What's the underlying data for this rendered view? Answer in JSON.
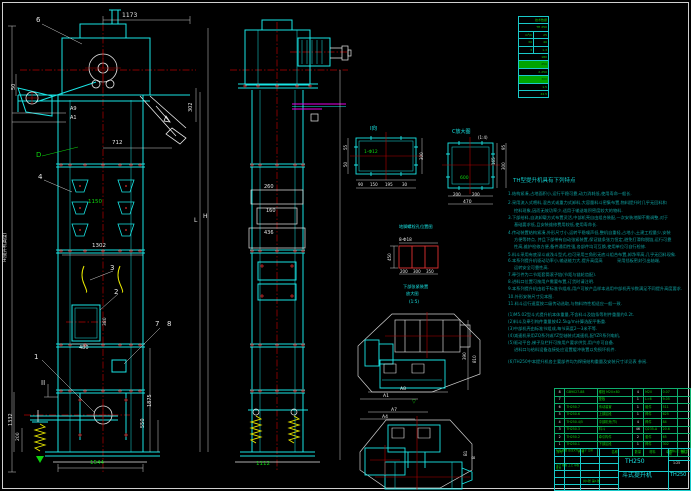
{
  "sheet_title": "TH250 斗式提升机 总图",
  "tech_table": {
    "name": "技术数据表",
    "rows": [
      {
        "cells": [
          "技术数据"
        ],
        "hl": false
      },
      {
        "cells": [
          "TH 250"
        ],
        "hl": false
      },
      {
        "cells": [
          "m³/h",
          "25"
        ],
        "hl": false
      },
      {
        "cells": [
          "30",
          "40"
        ],
        "hl": false
      },
      {
        "cells": [
          "3",
          "1.3"
        ],
        "hl": false
      },
      {
        "cells": [
          "180"
        ],
        "hl": false
      },
      {
        "cells": [
          "250"
        ],
        "hl": true
      },
      {
        "cells": [
          "2-250"
        ],
        "hl": false
      },
      {
        "cells": [
          "300"
        ],
        "hl": true
      },
      {
        "cells": [
          "1.5"
        ],
        "hl": false
      },
      {
        "cells": [
          "44.5"
        ],
        "hl": false
      }
    ]
  },
  "notes": {
    "title": {
      "t": "TH型提升机具有下列特点",
      "x": 513,
      "y": 179
    },
    "lines": [
      {
        "t": "1.结构紧凑,占地面积小,运行平稳可靠,动力消耗低,使用寿命—般长.",
        "x": 508,
        "y": 192
      },
      {
        "t": "2.采用流入式喂料,混合式或重力式卸料,大容量料斗密集布置,物料提升时几乎无回料和",
        "x": 508,
        "y": 201
      },
      {
        "t": "挖料现象,因而无效功率少,适用于输送堆积密度较大的物料.",
        "x": 514,
        "y": 209
      },
      {
        "t": "3.下部给料,自流卸载方式布置灵活,中部机壳自由组合装配,—次安装地脚不需调整,对于",
        "x": 508,
        "y": 216
      },
      {
        "t": "基础要求低,且安装维修费用较低,使用寿命长.",
        "x": 514,
        "y": 223
      },
      {
        "t": "4.传动装置结构紧凑,外形尺寸小,运转平稳噪声低,整机自重轻,占地小,土建工程量少,安装",
        "x": 508,
        "y": 231
      },
      {
        "t": "方便等特点, 并且下部带有自动张紧装置,保证链条张力恒定,避免打滑和脱链,运行可靠",
        "x": 514,
        "y": 238
      },
      {
        "t": "性高,维护检修方便,备件通用性强,各部件均可互换,使用单位可自行检修.",
        "x": 514,
        "y": 245
      },
      {
        "t": "5.料斗采用有底深斗或浅斗型式,也可采用三角形无底斗组合布置,卸净率高,几乎无回料现象.",
        "x": 508,
        "y": 253
      },
      {
        "t": "6.本系列提升机驱动功率小,输送能力大,提升高度高",
        "x": 508,
        "y": 259
      },
      {
        "t": "采用挡板密封引出轴端,",
        "x": 617,
        "y": 259
      },
      {
        "t": "运转安全可靠性高.",
        "x": 514,
        "y": 266
      },
      {
        "t": "7.牵引件为二节距套筒滚子链(节距与链轮齿配).",
        "x": 508,
        "y": 273
      },
      {
        "t": "8.进料口位置可按用户需要布置,订货时请注明.",
        "x": 508,
        "y": 280
      },
      {
        "t": "9.本系列提升机由若干标准节组成,用户可按产品样本选用中部机壳节数满足不同提升高度要求.",
        "x": 508,
        "y": 287
      },
      {
        "t": "10.外形安装尺寸见本图.",
        "x": 508,
        "y": 295
      },
      {
        "t": "11.料斗运行速度按二级传动选取,与物料特性相适应—般—致.",
        "x": 508,
        "y": 302
      },
      {
        "t": "(1)M5.02型斗式提升机本体重量,不含料斗及链条等附件重量约0.2t.",
        "x": 508,
        "y": 313
      },
      {
        "t": "(2)料斗及牵引构件重量按42.5kg/m计算选配平衡重.",
        "x": 508,
        "y": 320
      },
      {
        "t": "(3)中部机壳由标准节组成,每节高度2—3米不等.",
        "x": 508,
        "y": 327
      },
      {
        "t": "(4)减速机采用ZQ系列或YZ型轴装式减速机,配YZR系列电机,",
        "x": 508,
        "y": 334
      },
      {
        "t": "(5)驱动平台,梯子及栏杆可按用户要求供货,用户亦可自备.",
        "x": 508,
        "y": 341
      },
      {
        "t": "进料口与给料设备连接处应设置缓冲装置以免损坏机件.",
        "x": 514,
        "y": 348
      },
      {
        "t": "(6)TH250中本提升机各主要部件均为焊接结构重量及安装尺寸详见表 参阅.",
        "x": 508,
        "y": 360
      }
    ]
  },
  "bom": {
    "headers": [
      "序号",
      "代号",
      "名称",
      "数量",
      "材料",
      "单件",
      "备注"
    ],
    "rows": [
      [
        "8",
        "GB9027-88",
        "螺栓 M20×80",
        "4",
        "M20",
        "0.07",
        ""
      ],
      [
        "7",
        "",
        "垫板",
        "1",
        "L=6",
        "9.05",
        ""
      ],
      [
        "6",
        "TH250.7",
        "传动装置",
        "1",
        "组件",
        "511",
        ""
      ],
      [
        "5",
        "TH250.6",
        "上部区段",
        "1",
        "焊件",
        "625",
        ""
      ],
      [
        "4",
        "TH250.4/5",
        "中部机壳(节)",
        "4",
        "焊件",
        "84",
        ""
      ],
      [
        "3",
        "TH250.3",
        "料斗",
        "46",
        "Q235-A",
        "20.6",
        ""
      ],
      [
        "2",
        "TH250.2",
        "牵引构件",
        "2",
        "套件",
        "65",
        ""
      ],
      [
        "1",
        "TH250.1",
        "下部区段",
        "1",
        "焊件",
        "302",
        ""
      ]
    ]
  },
  "title_block": {
    "model": "TH250",
    "product_name": "斗式提升机",
    "drawing_no": "TH250",
    "scale": "1:25",
    "rev_row": "标记 处数 更改文件号 签字 日期",
    "sign_rows": "设计 校核 工艺 审核 批准",
    "sheet_info": "共1张 第1张",
    "stamp_grid": "图样标记 重量 比例"
  },
  "annotations": [
    {
      "t": "1173",
      "x": 122,
      "y": 13,
      "c": "#e8e8e8",
      "s": 6
    },
    {
      "t": "50",
      "x": 12,
      "y": 90,
      "c": "#e8e8e8",
      "s": 5,
      "r": -90
    },
    {
      "t": "A9",
      "x": 70,
      "y": 107,
      "c": "#e8e8e8",
      "s": 5
    },
    {
      "t": "A1",
      "x": 70,
      "y": 116,
      "c": "#e8e8e8",
      "s": 5
    },
    {
      "t": "712",
      "x": 112,
      "y": 141,
      "c": "#e8e8e8",
      "s": 5.5
    },
    {
      "t": "302",
      "x": 189,
      "y": 112,
      "c": "#e8e8e8",
      "s": 5,
      "r": -90
    },
    {
      "t": "D",
      "x": 36,
      "y": 152,
      "c": "#0ed20e",
      "s": 7
    },
    {
      "t": "6",
      "x": 36,
      "y": 17,
      "c": "#e8e8e8",
      "s": 7
    },
    {
      "t": "4",
      "x": 38,
      "y": 174,
      "c": "#e8e8e8",
      "s": 7
    },
    {
      "t": "1150",
      "x": 88,
      "y": 200,
      "c": "#0ed20e",
      "s": 5.5
    },
    {
      "t": "1302",
      "x": 92,
      "y": 244,
      "c": "#e8e8e8",
      "s": 5.5
    },
    {
      "t": "3",
      "x": 110,
      "y": 265,
      "c": "#e8e8e8",
      "s": 7
    },
    {
      "t": "2",
      "x": 114,
      "y": 289,
      "c": "#e8e8e8",
      "s": 7
    },
    {
      "t": "480",
      "x": 79,
      "y": 346,
      "c": "#e8e8e8",
      "s": 5
    },
    {
      "t": "380",
      "x": 104,
      "y": 326,
      "c": "#e8e8e8",
      "s": 4.5,
      "r": -90
    },
    {
      "t": "7",
      "x": 155,
      "y": 321,
      "c": "#e8e8e8",
      "s": 7
    },
    {
      "t": "8",
      "x": 167,
      "y": 321,
      "c": "#e8e8e8",
      "s": 7
    },
    {
      "t": "1",
      "x": 34,
      "y": 354,
      "c": "#e8e8e8",
      "s": 7
    },
    {
      "t": "II",
      "x": 41,
      "y": 380,
      "c": "#e8e8e8",
      "s": 7
    },
    {
      "t": "1875",
      "x": 148,
      "y": 407,
      "c": "#e8e8e8",
      "s": 5,
      "r": -90
    },
    {
      "t": "550",
      "x": 141,
      "y": 428,
      "c": "#e8e8e8",
      "s": 5,
      "r": -90
    },
    {
      "t": "1332",
      "x": 9,
      "y": 426,
      "c": "#e8e8e8",
      "s": 5,
      "r": -90
    },
    {
      "t": "200",
      "x": 17,
      "y": 441,
      "c": "#e8e8e8",
      "s": 4.5,
      "r": -90
    },
    {
      "t": "1544",
      "x": 90,
      "y": 461,
      "c": "#0ed20e",
      "s": 5.5
    },
    {
      "t": "H(提升机高度)",
      "x": 4,
      "y": 262,
      "c": "#e8e8e8",
      "s": 4.5,
      "r": -90
    },
    {
      "t": "L",
      "x": 194,
      "y": 218,
      "c": "#e8e8e8",
      "s": 6
    },
    {
      "t": "H",
      "x": 203,
      "y": 214,
      "c": "#e8e8e8",
      "s": 6
    },
    {
      "t": "260",
      "x": 264,
      "y": 185,
      "c": "#e8e8e8",
      "s": 5
    },
    {
      "t": "160",
      "x": 266,
      "y": 209,
      "c": "#e8e8e8",
      "s": 5
    },
    {
      "t": "436",
      "x": 264,
      "y": 231,
      "c": "#e8e8e8",
      "s": 5
    },
    {
      "t": "1112",
      "x": 256,
      "y": 462,
      "c": "#0ed20e",
      "s": 5.5
    },
    {
      "t": "I向",
      "x": 370,
      "y": 127,
      "c": "#19e5e5",
      "s": 5.5
    },
    {
      "t": "1-Φ12",
      "x": 364,
      "y": 151,
      "c": "#0ed20e",
      "s": 4.5
    },
    {
      "t": "55",
      "x": 344,
      "y": 150,
      "c": "#e8e8e8",
      "s": 4,
      "r": -90
    },
    {
      "t": "50",
      "x": 344,
      "y": 167,
      "c": "#e8e8e8",
      "s": 4,
      "r": -90
    },
    {
      "t": "300",
      "x": 420,
      "y": 160,
      "c": "#e8e8e8",
      "s": 4,
      "r": -90
    },
    {
      "t": "90",
      "x": 358,
      "y": 183,
      "c": "#e8e8e8",
      "s": 4
    },
    {
      "t": "150",
      "x": 370,
      "y": 183,
      "c": "#e8e8e8",
      "s": 4
    },
    {
      "t": "195",
      "x": 385,
      "y": 183,
      "c": "#e8e8e8",
      "s": 4
    },
    {
      "t": "30",
      "x": 402,
      "y": 183,
      "c": "#e8e8e8",
      "s": 4
    },
    {
      "t": "C放大图",
      "x": 452,
      "y": 130,
      "c": "#19e5e5",
      "s": 5
    },
    {
      "t": "(1:4)",
      "x": 478,
      "y": 136,
      "c": "#e8e8e8",
      "s": 4
    },
    {
      "t": "600",
      "x": 460,
      "y": 177,
      "c": "#0ed20e",
      "s": 4.5
    },
    {
      "t": "165",
      "x": 492,
      "y": 165,
      "c": "#e8e8e8",
      "s": 4,
      "r": -90
    },
    {
      "t": "95",
      "x": 502,
      "y": 150,
      "c": "#e8e8e8",
      "s": 4,
      "r": -90
    },
    {
      "t": "300",
      "x": 502,
      "y": 170,
      "c": "#e8e8e8",
      "s": 4,
      "r": -90
    },
    {
      "t": "200",
      "x": 453,
      "y": 193,
      "c": "#e8e8e8",
      "s": 4
    },
    {
      "t": "200",
      "x": 472,
      "y": 193,
      "c": "#e8e8e8",
      "s": 4
    },
    {
      "t": "470",
      "x": 463,
      "y": 201,
      "c": "#e8e8e8",
      "s": 4.5
    },
    {
      "t": "地脚螺栓孔位置图",
      "x": 399,
      "y": 225,
      "c": "#19e5e5",
      "s": 4.2
    },
    {
      "t": "8-Φ18",
      "x": 399,
      "y": 238,
      "c": "#e8e8e8",
      "s": 4.2
    },
    {
      "t": "450",
      "x": 388,
      "y": 261,
      "c": "#e8e8e8",
      "s": 4,
      "r": -90
    },
    {
      "t": "200",
      "x": 400,
      "y": 270,
      "c": "#e8e8e8",
      "s": 4
    },
    {
      "t": "300",
      "x": 413,
      "y": 270,
      "c": "#e8e8e8",
      "s": 4
    },
    {
      "t": "350",
      "x": 426,
      "y": 270,
      "c": "#e8e8e8",
      "s": 4
    },
    {
      "t": "下部张紧装置",
      "x": 403,
      "y": 285,
      "c": "#19e5e5",
      "s": 4.2
    },
    {
      "t": "放大图",
      "x": 406,
      "y": 292,
      "c": "#19e5e5",
      "s": 4.2
    },
    {
      "t": "(1:5)",
      "x": 409,
      "y": 300,
      "c": "#19e5e5",
      "s": 4.2
    },
    {
      "t": "390",
      "x": 463,
      "y": 360,
      "c": "#e8e8e8",
      "s": 4,
      "r": -90
    },
    {
      "t": "810",
      "x": 473,
      "y": 363,
      "c": "#e8e8e8",
      "s": 4,
      "r": -90
    },
    {
      "t": "A8",
      "x": 400,
      "y": 388,
      "c": "#e8e8e8",
      "s": 4.5
    },
    {
      "t": "A1",
      "x": 383,
      "y": 395,
      "c": "#e8e8e8",
      "s": 4.5
    },
    {
      "t": "A7",
      "x": 391,
      "y": 409,
      "c": "#e8e8e8",
      "s": 4.5
    },
    {
      "t": "A4",
      "x": 382,
      "y": 416,
      "c": "#e8e8e8",
      "s": 4.5
    },
    {
      "t": "▽",
      "x": 412,
      "y": 400,
      "c": "#0ed20e",
      "s": 5
    },
    {
      "t": "B1",
      "x": 464,
      "y": 456,
      "c": "#e8e8e8",
      "s": 4,
      "r": -90
    },
    {
      "t": "B",
      "x": 472,
      "y": 459,
      "c": "#e8e8e8",
      "s": 4,
      "r": -90
    }
  ]
}
